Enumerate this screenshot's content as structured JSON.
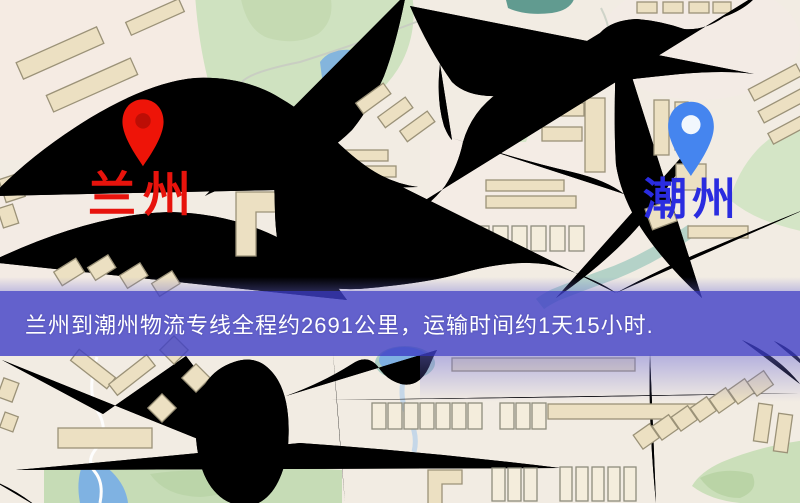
{
  "map": {
    "markers": [
      {
        "id": "origin",
        "name": "兰州",
        "pin_icon": "map-pin",
        "pin_color": "#ee1408",
        "label_color": "#e7130c"
      },
      {
        "id": "destination",
        "name": "潮州",
        "pin_icon": "map-pin",
        "pin_color": "#4585ef",
        "label_color": "#2a2ce0"
      }
    ],
    "theme": {
      "background": "#f2ece3",
      "road_fill": "#f7d07a",
      "road_casing": "#e0a94e",
      "park_green": "#cfe2c0",
      "water_blue": "#7fb2e2",
      "railway_dark": "#2b2b2b",
      "building_fill": "#ece0c2",
      "building_stroke": "#9b9278"
    }
  },
  "banner": {
    "text": "兰州到潮州物流专线全程约2691公里，运输时间约1天15小时.",
    "background_color": "#3e3fc6",
    "text_color": "#ffffff"
  },
  "route": {
    "origin": "兰州",
    "destination": "潮州",
    "distance_text": "约2691公里",
    "duration_text": "约1天15小时"
  }
}
